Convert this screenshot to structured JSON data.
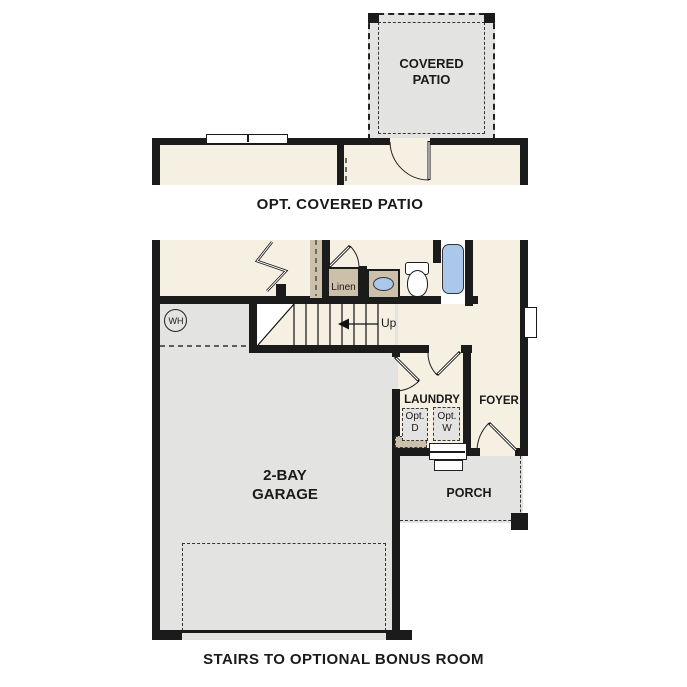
{
  "colors": {
    "wall": "#1b1b1b",
    "beige": "#f6f0e3",
    "gray": "#e3e3e1",
    "tan": "#ccc0aa",
    "blue": "#abc8ea",
    "ink": "#1a1a1a",
    "white": "#ffffff"
  },
  "upper_plan": {
    "patio_line1": "COVERED",
    "patio_line2": "PATIO",
    "caption": "OPT. COVERED PATIO"
  },
  "main_plan": {
    "garage_line1": "2-BAY",
    "garage_line2": "GARAGE",
    "laundry_label": "LAUNDRY",
    "foyer_label": "FOYER",
    "porch_label": "PORCH",
    "linen_label": "Linen",
    "up_label": "Up",
    "water_heater_label": "WH",
    "opt_dryer_line1": "Opt.",
    "opt_dryer_line2": "D",
    "opt_washer_line1": "Opt.",
    "opt_washer_line2": "W",
    "caption": "STAIRS TO OPTIONAL BONUS ROOM"
  }
}
